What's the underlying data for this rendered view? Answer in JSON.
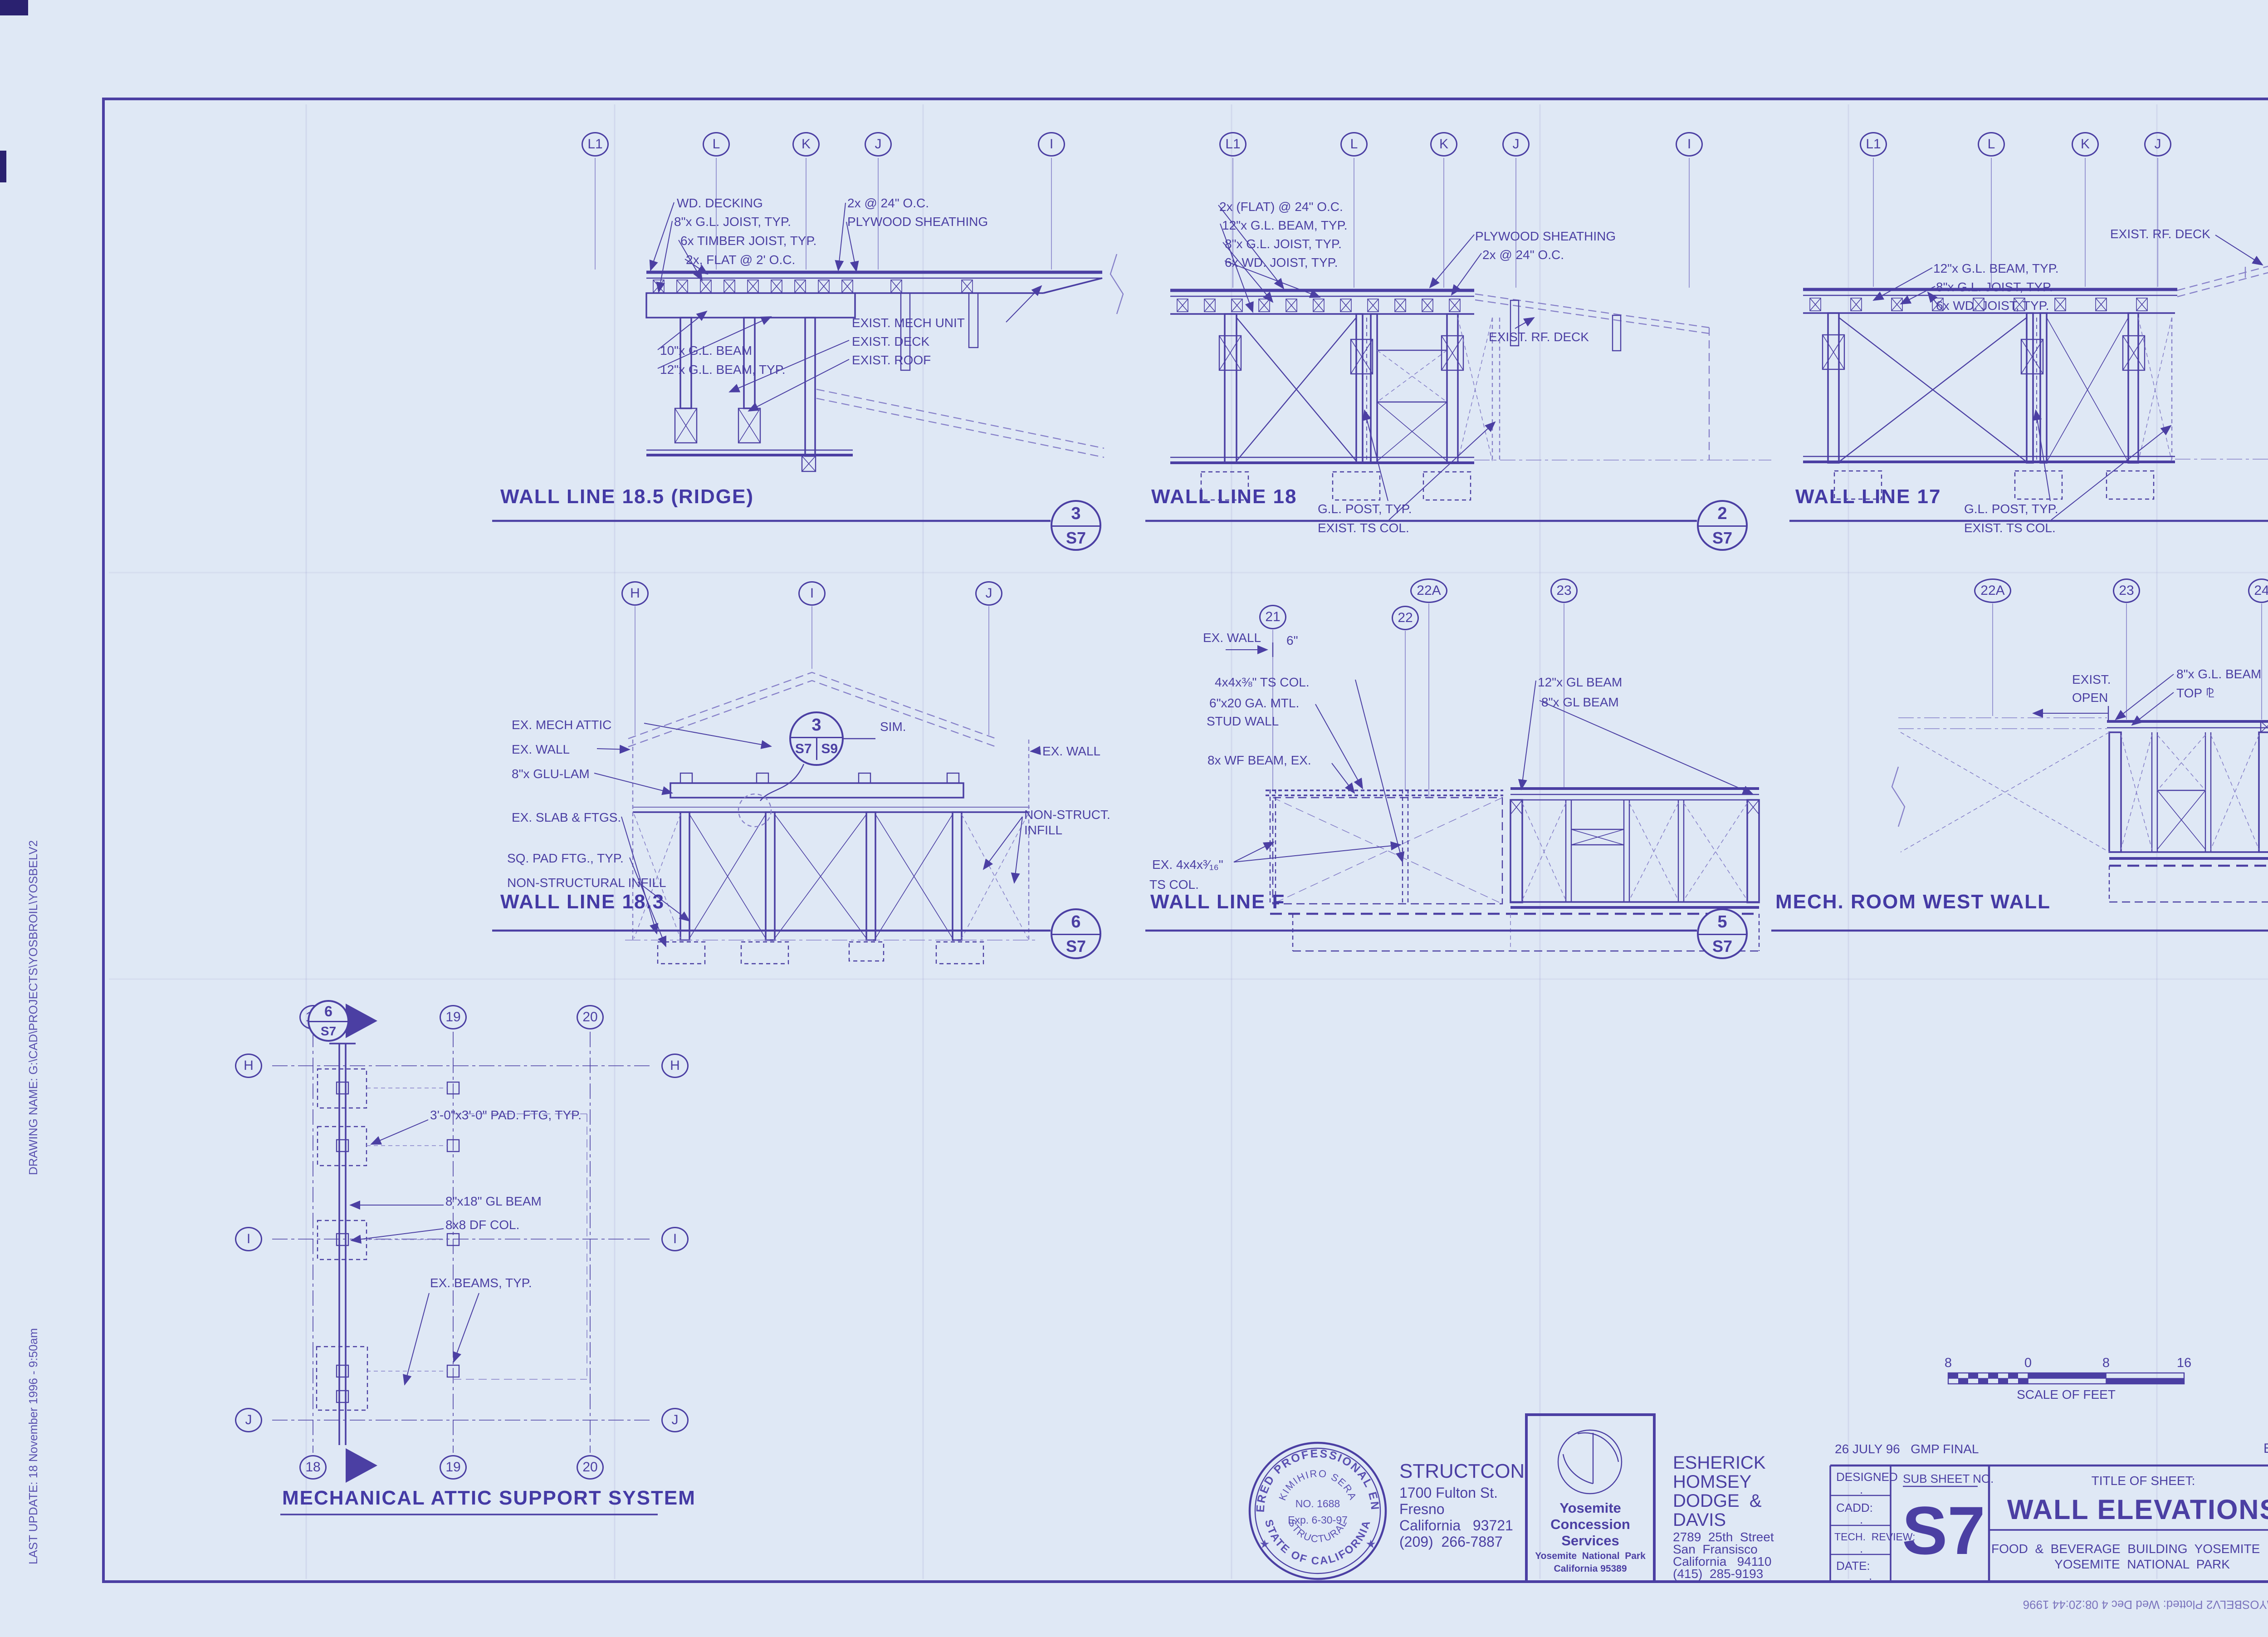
{
  "edge": {
    "drawing_name": "DRAWING NAME:   G:\\CAD\\PROJECTS\\YOSBROIL\\YOSBELV2",
    "last_update": "LAST UPDATE:   18 November 1996  -  9:50am",
    "plot_stamp": "File: G:\\CAD\\PROJECTS\\YOSBROIL\\YOSBELV2  Plotted:  Wed Dec  4 08:20:44 1996"
  },
  "panels": {
    "wl185": {
      "title": "WALL LINE 18.5 (RIDGE)",
      "detail_num": "3",
      "detail_sheet": "S7",
      "grid": [
        "L1",
        "L",
        "K",
        "J",
        "I"
      ],
      "ann": [
        "WD. DECKING",
        "8\"x G.L. JOIST, TYP.",
        "6x TIMBER JOIST, TYP.",
        "2x, FLAT @ 2' O.C.",
        "2x @ 24\" O.C.",
        "PLYWOOD SHEATHING",
        "10\"x G.L. BEAM",
        "12\"x G.L. BEAM, TYP.",
        "EXIST. MECH UNIT",
        "EXIST. DECK",
        "EXIST. ROOF"
      ]
    },
    "wl18": {
      "title": "WALL LINE 18",
      "detail_num": "2",
      "detail_sheet": "S7",
      "grid": [
        "L1",
        "L",
        "K",
        "J",
        "I"
      ],
      "ann": [
        "2x (FLAT) @ 24\" O.C.",
        "12\"x G.L. BEAM, TYP.",
        "8\"x G.L. JOIST, TYP.",
        "6x WD. JOIST, TYP.",
        "PLYWOOD SHEATHING",
        "2x @ 24\" O.C.",
        "EXIST. RF. DECK",
        "G.L. POST, TYP.",
        "EXIST. TS COL."
      ]
    },
    "wl17": {
      "title": "WALL LINE 17",
      "detail_num": "1",
      "detail_sheet": "S7",
      "grid": [
        "L1",
        "L",
        "K",
        "J",
        "I"
      ],
      "ann": [
        "EXIST. RF. DECK",
        "12\"x G.L. BEAM, TYP.",
        "8\"x G.L. JOIST, TYP.",
        "6x WD. JOIST, TYP.",
        "G.L. POST, TYP.",
        "EXIST. TS COL."
      ]
    },
    "wl183": {
      "title": "WALL LINE 18.3",
      "detail_num": "6",
      "detail_sheet": "S7",
      "grid": [
        "H",
        "I",
        "J"
      ],
      "sim_num": "3",
      "sim_s1": "S7",
      "sim_s2": "S9",
      "sim_label": "SIM.",
      "ann": [
        "EX. MECH ATTIC",
        "EX. WALL",
        "8\"x GLU-LAM",
        "EX. SLAB & FTGS.",
        "SQ. PAD FTG., TYP.",
        "NON-STRUCTURAL INFILL",
        "EX. WALL",
        "NON-STRUCT.",
        "INFILL"
      ]
    },
    "wlf": {
      "title": "WALL LINE F",
      "detail_num": "5",
      "detail_sheet": "S7",
      "grid": [
        "21",
        "22A",
        "22",
        "23"
      ],
      "ann": [
        "EX. WALL",
        "6\"",
        "4x4x⅜\" TS COL.",
        "6\"x20 GA. MTL.",
        "STUD WALL",
        "8x WF BEAM, EX.",
        "12\"x GL BEAM",
        "8\"x GL BEAM",
        "EX. 4x4x³⁄₁₆\"",
        "TS COL."
      ]
    },
    "mrww": {
      "title": "MECH. ROOM WEST WALL",
      "detail_num": "4",
      "detail_sheet": "S7",
      "grid": [
        "22A",
        "23",
        "24"
      ],
      "ann": [
        "EXIST.",
        "OPEN",
        "8\"x G.L. BEAM",
        "TOP ⅊"
      ]
    },
    "plan": {
      "title": "MECHANICAL ATTIC SUPPORT SYSTEM",
      "marker_num": "6",
      "marker_sheet": "S7",
      "grid_cols": [
        "18",
        "19",
        "20"
      ],
      "grid_rows": [
        "H",
        "I",
        "J"
      ],
      "ann": [
        "3'-0\"x3'-0\" PAD. FTG, TYP.",
        "8\"x18\" GL BEAM",
        "8x8 DF COL.",
        "EX. BEAMS, TYP."
      ]
    }
  },
  "title_block": {
    "date_note": "26 JULY 96   GMP FINAL",
    "project_note": "EHDD PROJECT #9558",
    "fields": {
      "designed_label": "DESIGNED",
      "designed_value": ".",
      "cadd_label": "CADD:",
      "cadd_value": ".",
      "tech_label": "TECH.  REVIEW:",
      "tech_value": ".",
      "date_label": "DATE:",
      "date_value": "."
    },
    "sub_sheet_label": "SUB SHEET NO.",
    "sub_sheet": "S7",
    "title_label": "TITLE OF SHEET:",
    "sheet_title": "WALL ELEVATIONS",
    "project_line1": "FOOD  &  BEVERAGE  BUILDING  YOSEMITE  LODGE",
    "project_line2": "YOSEMITE  NATIONAL  PARK",
    "drawing_no_label": "DRAWING NO.",
    "drawing_no": "8800/70146",
    "pkg_label1": "PKG.",
    "pkg_label2": "NO.",
    "sheet_label": "SHEET",
    "sheet_no": "54",
    "of_label": "OF",
    "total": "101."
  },
  "scale_bar": {
    "labels": [
      "8",
      "0",
      "8",
      "16"
    ],
    "caption": "SCALE OF FEET"
  },
  "stamp": {
    "ring_top": "REGISTERED PROFESSIONAL ENGINEER",
    "ring_bottom": "STATE OF CALIFORNIA",
    "name": "KIMIHIRO SERA",
    "no": "NO. 1688",
    "exp": "Exp. 6-30-97",
    "discipline": "STRUCTURAL",
    "star": "★"
  },
  "firms": {
    "structcon": {
      "name": "STRUCTCON",
      "addr1": "1700 Fulton St.",
      "addr2": "Fresno",
      "addr3": "California   93721",
      "phone": "(209)  266-7887"
    },
    "ycs": {
      "line1": "Yosemite",
      "line2": "Concession",
      "line3": "Services",
      "line4": "Yosemite  National  Park",
      "line5": "California 95389"
    },
    "ehdd": {
      "n1": "ESHERICK",
      "n2": "HOMSEY",
      "n3": "DODGE  &",
      "n4": "DAVIS",
      "addr1": "2789  25th  Street",
      "addr2": "San  Fransisco",
      "addr3": "California   94110",
      "phone": "(415)  285-9193"
    }
  },
  "colors": {
    "ink": "#4b3fa3",
    "paper": "#dfe8f5"
  }
}
